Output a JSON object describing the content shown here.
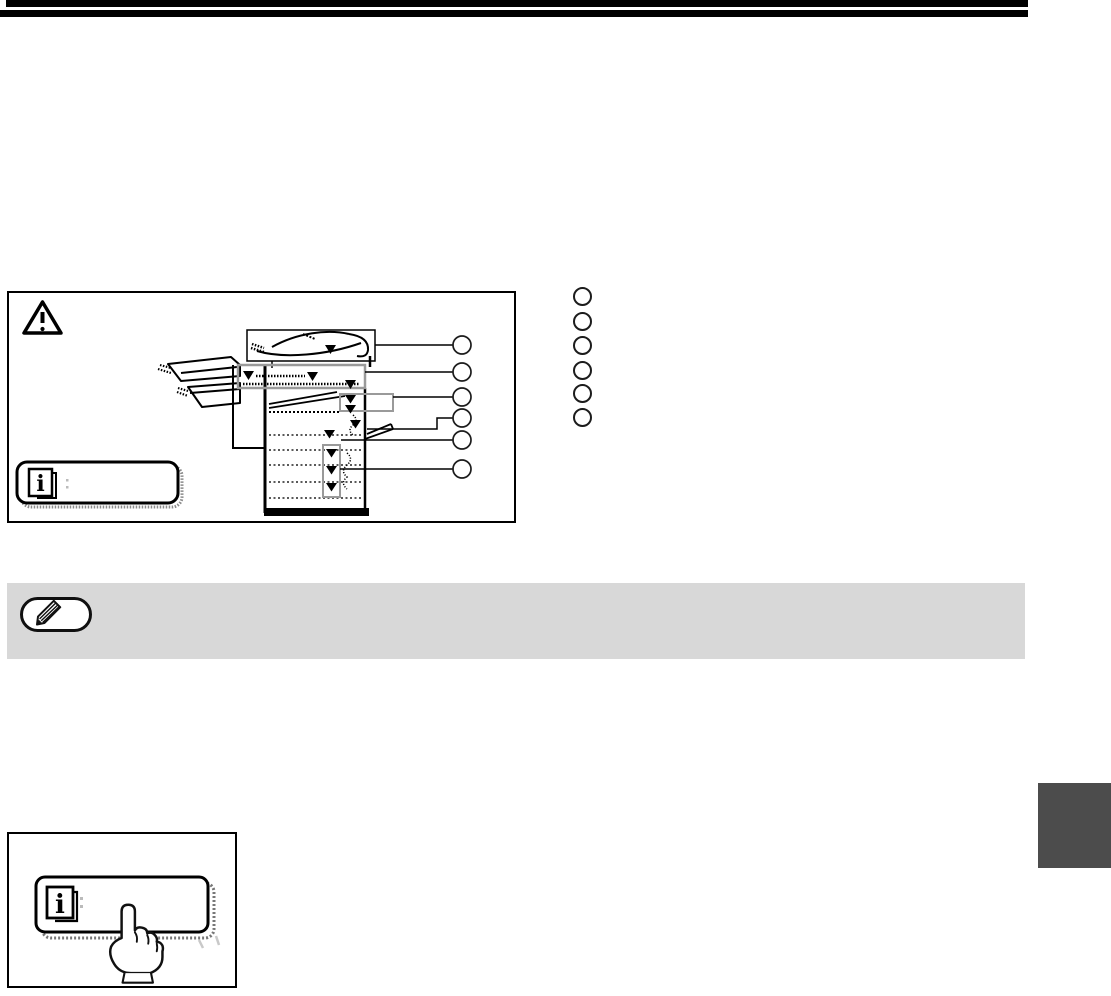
{
  "page": {
    "kind": "operation manual page (graphics only, no rendered text)",
    "background_color": "#ffffff",
    "header_rule_color": "#000000",
    "header_rule_count": 2
  },
  "figure": {
    "description": "misfeed-locations diagram of a copier",
    "border_color": "#000000",
    "callout_box_border_color": "#9a9a9a",
    "misfeed_marker_glyph": "▼",
    "figure_circle_count": 6,
    "warning_icon": "warning-triangle-icon",
    "info_key_icon": "information-key-icon"
  },
  "legend": {
    "circle_count": 6,
    "circle_border_color": "#1c1c1c"
  },
  "note": {
    "bar_color": "#d8d8d8",
    "icon": "pencil-note-icon",
    "pill_border_color": "#101010"
  },
  "edge_tab": {
    "color": "#4c4c4c"
  },
  "bottom_figure": {
    "description": "hand pressing the INFORMATION key",
    "border_color": "#000000",
    "button_icon": "information-key-icon",
    "pointer_icon": "pointing-hand-icon"
  },
  "icons": {
    "info_glyph": "i"
  }
}
